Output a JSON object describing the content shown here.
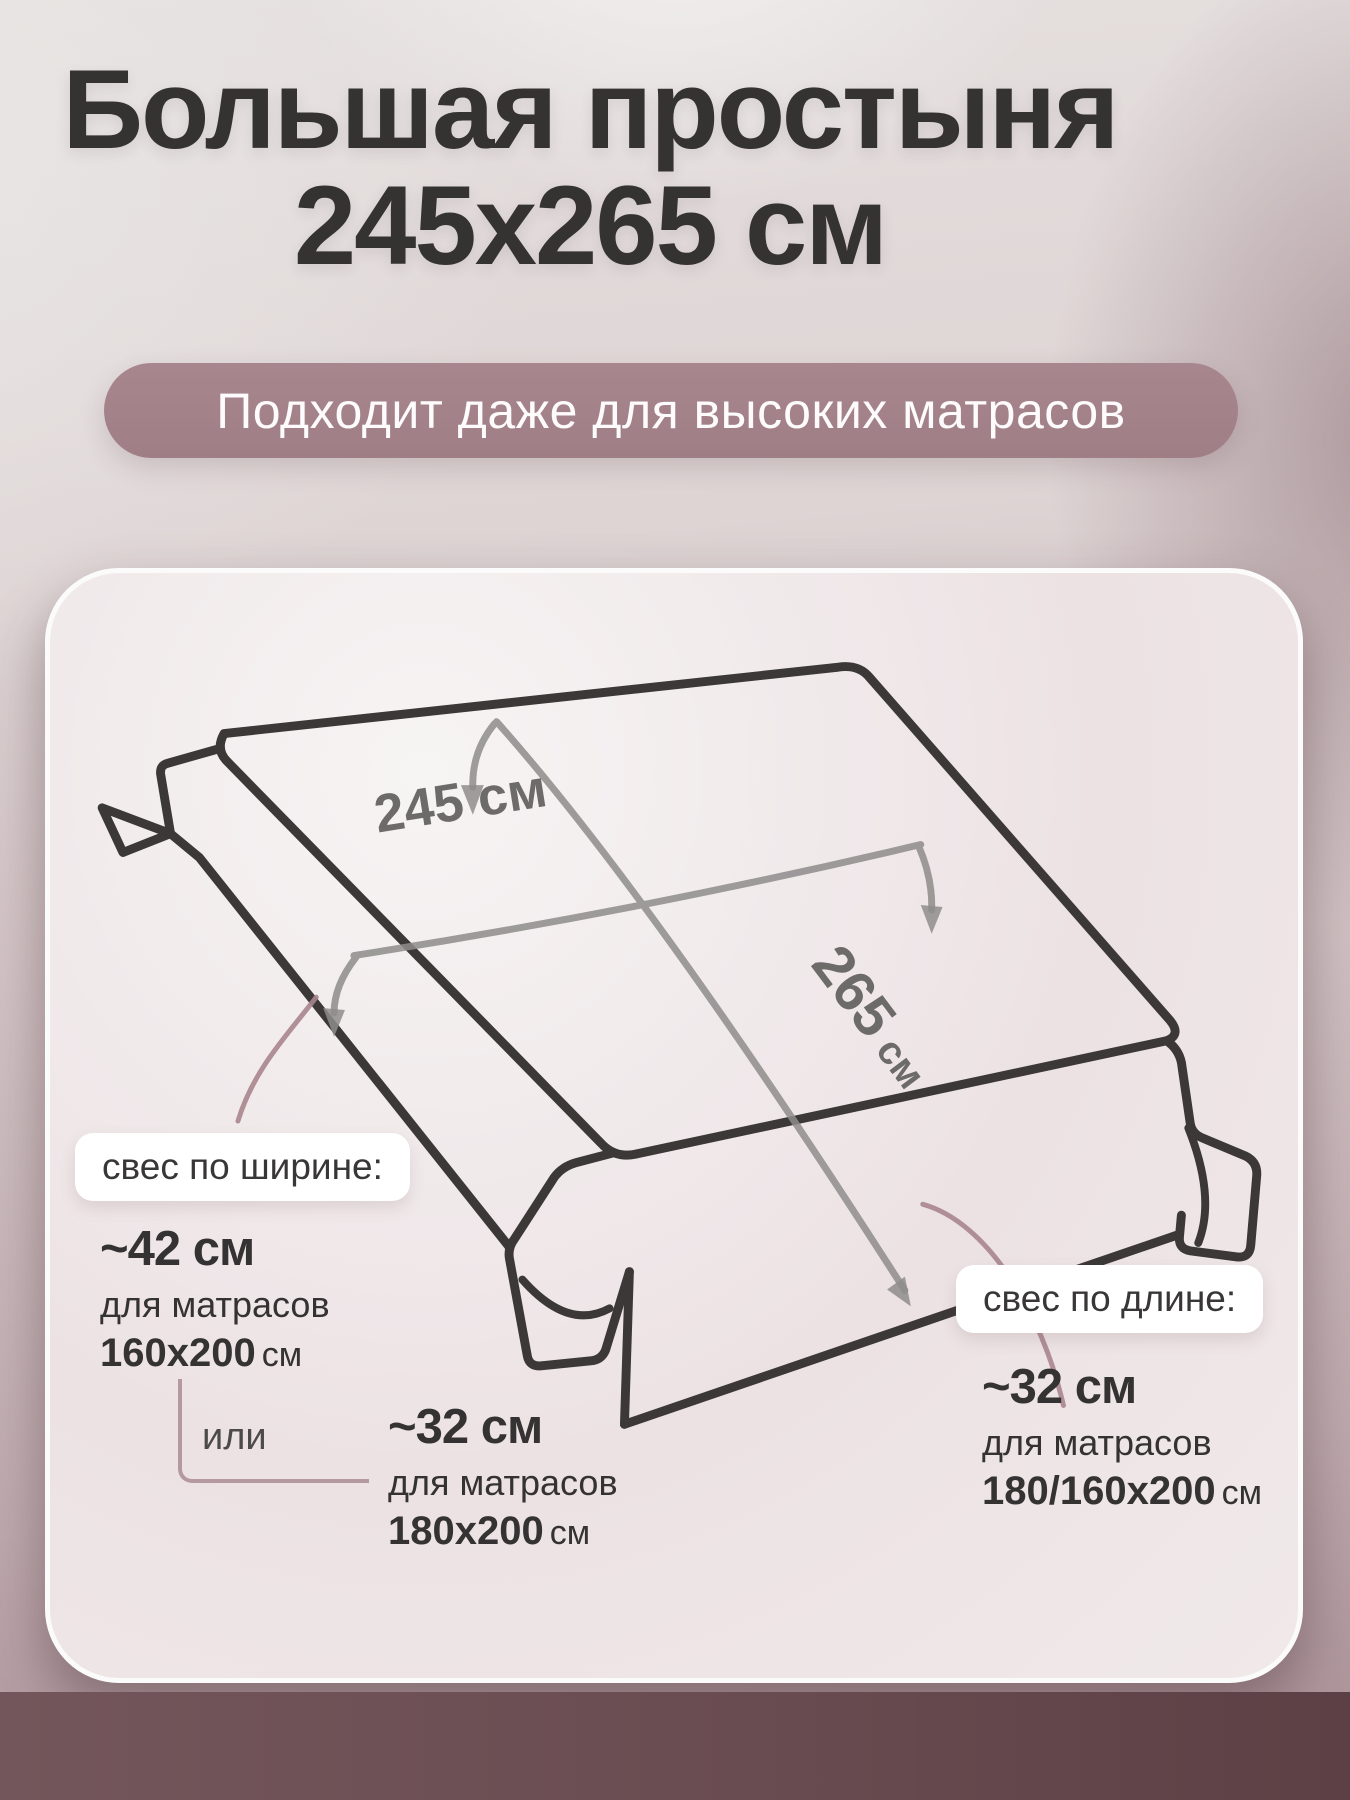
{
  "header": {
    "title_line1": "Большая простыня",
    "title_line2": "245х265 см",
    "badge": "Подходит даже для высоких матрасов"
  },
  "diagram": {
    "width_label": "245 см",
    "length_value": "265",
    "length_unit": "см",
    "or_label": "или",
    "width_callout": {
      "pill": "свес по ширине:",
      "value": "~42 см",
      "note": "для матрасов",
      "size": "160х200",
      "size_unit": "см"
    },
    "width_alt_callout": {
      "value": "~32 см",
      "note": "для матрасов",
      "size": "180х200",
      "size_unit": "см"
    },
    "length_callout": {
      "pill": "свес по длине:",
      "value": "~32 см",
      "note": "для матрасов",
      "size": "180/160х200",
      "size_unit": "см"
    }
  },
  "colors": {
    "title_text": "#353332",
    "badge_bg": "#a5838b",
    "card_bg": "#f0e8e9",
    "sheet_outline": "#3b3837",
    "measure_gray": "#8f8c8c",
    "connector_mauve": "#a8858d",
    "bottom_band": "#694c51"
  }
}
